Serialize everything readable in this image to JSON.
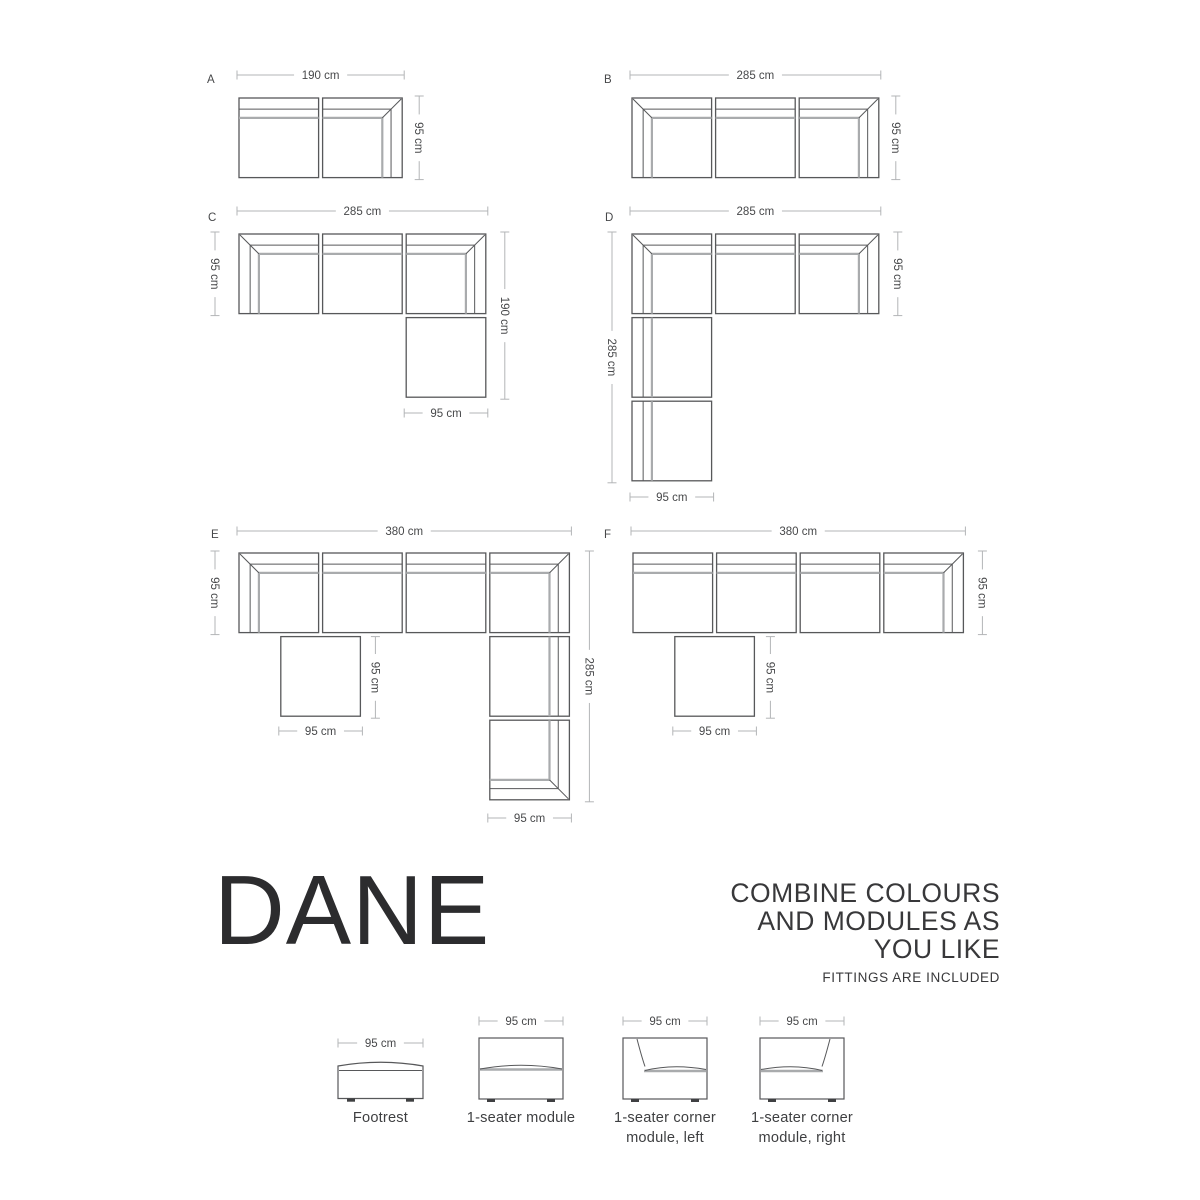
{
  "colors": {
    "outline": "#57585a",
    "soft": "#a9abad",
    "dim": "#b3b5b7",
    "text": "#47484a",
    "dark": "#3f4042"
  },
  "scale_px_per_cm": 0.88,
  "module_size_cm": 95,
  "texts": {
    "title": "DANE",
    "tagline_lines": [
      "COMBINE COLOURS",
      "AND MODULES AS",
      "YOU LIKE"
    ],
    "note": "FITTINGS ARE INCLUDED"
  },
  "configurations": [
    {
      "id": "A",
      "label": "A",
      "label_pos": {
        "x": 207,
        "y": 83
      },
      "origin": {
        "x": 237,
        "y": 96
      },
      "size_cm": {
        "w": 190,
        "h": 95
      },
      "modules": [
        {
          "type": "back-top",
          "cx": 0,
          "cy": 0
        },
        {
          "type": "corner-top-right",
          "cx": 95,
          "cy": 0
        }
      ],
      "dims": [
        {
          "o": "h",
          "label": "190 cm",
          "a": 237,
          "b": 404.2,
          "at": 75
        },
        {
          "o": "v",
          "label": "95 cm",
          "a": 96,
          "b": 179.6,
          "at": 419.2
        }
      ]
    },
    {
      "id": "B",
      "label": "B",
      "label_pos": {
        "x": 604,
        "y": 83
      },
      "origin": {
        "x": 630,
        "y": 96
      },
      "size_cm": {
        "w": 285,
        "h": 95
      },
      "modules": [
        {
          "type": "corner-top-left",
          "cx": 0,
          "cy": 0
        },
        {
          "type": "back-top",
          "cx": 95,
          "cy": 0
        },
        {
          "type": "corner-top-right",
          "cx": 190,
          "cy": 0
        }
      ],
      "dims": [
        {
          "o": "h",
          "label": "285 cm",
          "a": 630,
          "b": 880.8,
          "at": 75
        },
        {
          "o": "v",
          "label": "95 cm",
          "a": 96,
          "b": 179.6,
          "at": 895.8
        }
      ]
    },
    {
      "id": "C",
      "label": "C",
      "label_pos": {
        "x": 208,
        "y": 221
      },
      "origin": {
        "x": 237,
        "y": 232
      },
      "size_cm": {
        "w": 285,
        "h": 190
      },
      "modules": [
        {
          "type": "corner-top-left",
          "cx": 0,
          "cy": 0
        },
        {
          "type": "back-top",
          "cx": 95,
          "cy": 0
        },
        {
          "type": "corner-top-right",
          "cx": 190,
          "cy": 0
        },
        {
          "type": "footrest",
          "cx": 190,
          "cy": 95
        }
      ],
      "dims": [
        {
          "o": "h",
          "label": "285 cm",
          "a": 237,
          "b": 487.8,
          "at": 211
        },
        {
          "o": "v",
          "label": "95 cm",
          "a": 232,
          "b": 315.6,
          "at": 215
        },
        {
          "o": "v",
          "label": "190 cm",
          "a": 232,
          "b": 399.2,
          "at": 504.8
        },
        {
          "o": "h",
          "label": "95 cm",
          "a": 404.2,
          "b": 487.8,
          "at": 413
        }
      ]
    },
    {
      "id": "D",
      "label": "D",
      "label_pos": {
        "x": 605,
        "y": 221
      },
      "origin": {
        "x": 630,
        "y": 232
      },
      "size_cm": {
        "w": 285,
        "h": 285
      },
      "modules": [
        {
          "type": "corner-top-left",
          "cx": 0,
          "cy": 0
        },
        {
          "type": "back-top",
          "cx": 95,
          "cy": 0
        },
        {
          "type": "corner-top-right",
          "cx": 190,
          "cy": 0
        },
        {
          "type": "back-left",
          "cx": 0,
          "cy": 95
        },
        {
          "type": "back-left",
          "cx": 0,
          "cy": 190
        }
      ],
      "dims": [
        {
          "o": "h",
          "label": "285 cm",
          "a": 630,
          "b": 880.8,
          "at": 211
        },
        {
          "o": "v",
          "label": "95 cm",
          "a": 232,
          "b": 315.6,
          "at": 897.8
        },
        {
          "o": "v",
          "label": "285 cm",
          "a": 232,
          "b": 482.8,
          "at": 612
        },
        {
          "o": "h",
          "label": "95 cm",
          "a": 630,
          "b": 713.6,
          "at": 497
        }
      ]
    },
    {
      "id": "E",
      "label": "E",
      "label_pos": {
        "x": 211,
        "y": 538
      },
      "origin": {
        "x": 237,
        "y": 551
      },
      "size_cm": {
        "w": 380,
        "h": 285
      },
      "modules": [
        {
          "type": "corner-top-left",
          "cx": 0,
          "cy": 0
        },
        {
          "type": "back-top",
          "cx": 95,
          "cy": 0
        },
        {
          "type": "back-top",
          "cx": 190,
          "cy": 0
        },
        {
          "type": "corner-top-right",
          "cx": 285,
          "cy": 0
        },
        {
          "type": "footrest",
          "cx": 47.5,
          "cy": 95
        },
        {
          "type": "back-right",
          "cx": 285,
          "cy": 95
        },
        {
          "type": "corner-right-bottom",
          "cx": 285,
          "cy": 190
        }
      ],
      "dims": [
        {
          "o": "h",
          "label": "380 cm",
          "a": 237,
          "b": 571.4,
          "at": 531
        },
        {
          "o": "v",
          "label": "95 cm",
          "a": 551,
          "b": 634.6,
          "at": 215
        },
        {
          "o": "v",
          "label": "95 cm",
          "a": 636.6,
          "b": 718.2,
          "at": 375.4
        },
        {
          "o": "h",
          "label": "95 cm",
          "a": 278.8,
          "b": 362.4,
          "at": 731
        },
        {
          "o": "v",
          "label": "285 cm",
          "a": 551,
          "b": 801.8,
          "at": 589.4
        },
        {
          "o": "h",
          "label": "95 cm",
          "a": 487.8,
          "b": 571.4,
          "at": 818
        }
      ]
    },
    {
      "id": "F",
      "label": "F",
      "label_pos": {
        "x": 604,
        "y": 538
      },
      "origin": {
        "x": 631,
        "y": 551
      },
      "size_cm": {
        "w": 380,
        "h": 190
      },
      "modules": [
        {
          "type": "back-top",
          "cx": 0,
          "cy": 0
        },
        {
          "type": "back-top",
          "cx": 95,
          "cy": 0
        },
        {
          "type": "back-top",
          "cx": 190,
          "cy": 0
        },
        {
          "type": "corner-top-right",
          "cx": 285,
          "cy": 0
        },
        {
          "type": "footrest",
          "cx": 47.5,
          "cy": 95
        }
      ],
      "dims": [
        {
          "o": "h",
          "label": "380 cm",
          "a": 631,
          "b": 965.4,
          "at": 531
        },
        {
          "o": "v",
          "label": "95 cm",
          "a": 551,
          "b": 634.6,
          "at": 982.4
        },
        {
          "o": "v",
          "label": "95 cm",
          "a": 636.6,
          "b": 718.2,
          "at": 770.4
        },
        {
          "o": "h",
          "label": "95 cm",
          "a": 672.8,
          "b": 756.4,
          "at": 731
        }
      ]
    }
  ],
  "legend": {
    "items": [
      {
        "type": "footrest",
        "dim_label": "95 cm",
        "caption1": "Footrest",
        "caption2": "",
        "cx": 380.5,
        "dim_y": 1043
      },
      {
        "type": "seater",
        "dim_label": "95 cm",
        "caption1": "1-seater module",
        "caption2": "",
        "cx": 521,
        "dim_y": 1021
      },
      {
        "type": "corner-left",
        "dim_label": "95 cm",
        "caption1": "1-seater corner",
        "caption2": "module, left",
        "cx": 665,
        "dim_y": 1021
      },
      {
        "type": "corner-right",
        "dim_label": "95 cm",
        "caption1": "1-seater corner",
        "caption2": "module, right",
        "cx": 802,
        "dim_y": 1021
      }
    ]
  }
}
